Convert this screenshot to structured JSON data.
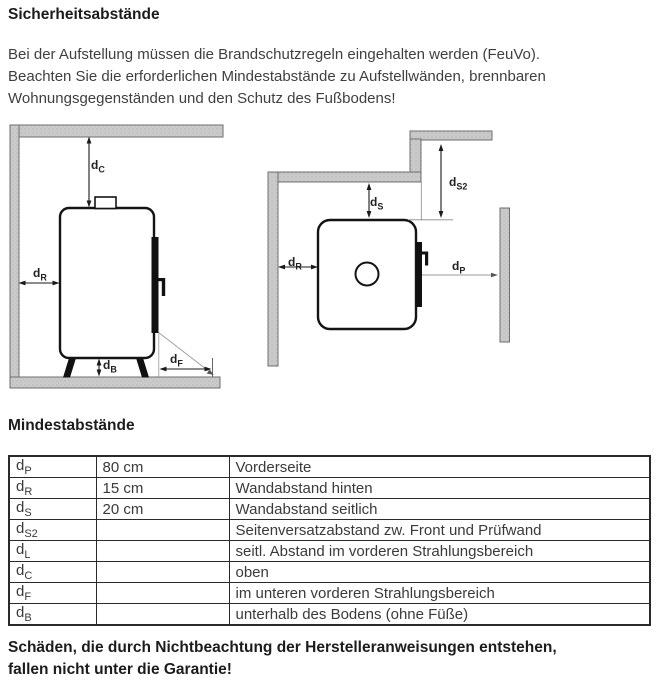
{
  "page": {
    "title": "Sicherheitsabstände",
    "intro_lines": [
      "Bei der Aufstellung müssen die Brandschutzregeln eingehalten werden (FeuVo).",
      "Beachten Sie die erforderlichen Mindestabstände zu Aufstellwänden, brennbaren",
      "Wohnungsgegenständen und den Schutz des Fußbodens!"
    ],
    "section2_title": "Mindestabstände",
    "warning_lines": [
      "Schäden, die durch Nichtbeachtung der Herstelleranweisungen entstehen,",
      "fallen nicht unter die Garantie!"
    ]
  },
  "diagrams": {
    "side_view": {
      "labels": {
        "dC": {
          "base": "d",
          "sub": "C"
        },
        "dR": {
          "base": "d",
          "sub": "R"
        },
        "dB": {
          "base": "d",
          "sub": "B"
        },
        "dF": {
          "base": "d",
          "sub": "F"
        }
      }
    },
    "top_view": {
      "labels": {
        "dS": {
          "base": "d",
          "sub": "S"
        },
        "dS2": {
          "base": "d",
          "sub": "S2"
        },
        "dR": {
          "base": "d",
          "sub": "R"
        },
        "dP": {
          "base": "d",
          "sub": "P"
        }
      }
    }
  },
  "table": {
    "rows": [
      {
        "base": "d",
        "sub": "P",
        "value": "80 cm",
        "desc": "Vorderseite"
      },
      {
        "base": "d",
        "sub": "R",
        "value": "15 cm",
        "desc": "Wandabstand hinten"
      },
      {
        "base": "d",
        "sub": "S",
        "value": "20 cm",
        "desc": "Wandabstand seitlich"
      },
      {
        "base": "d",
        "sub": "S2",
        "value": "",
        "desc": "Seitenversatzabstand zw. Front und Prüfwand"
      },
      {
        "base": "d",
        "sub": "L",
        "value": "",
        "desc": "seitl. Abstand im vorderen Strahlungsbereich"
      },
      {
        "base": "d",
        "sub": "C",
        "value": "",
        "desc": "oben"
      },
      {
        "base": "d",
        "sub": "F",
        "value": "",
        "desc": "im unteren vorderen Strahlungsbereich"
      },
      {
        "base": "d",
        "sub": "B",
        "value": "",
        "desc": "unterhalb des Bodens (ohne Füße)"
      }
    ]
  },
  "colors": {
    "wall_fill": "#cbcbcb",
    "wall_border": "#6e6e6e",
    "line": "#1a1a1a",
    "text_body": "#3a3a3a",
    "text_heading": "#1c1c1c"
  }
}
